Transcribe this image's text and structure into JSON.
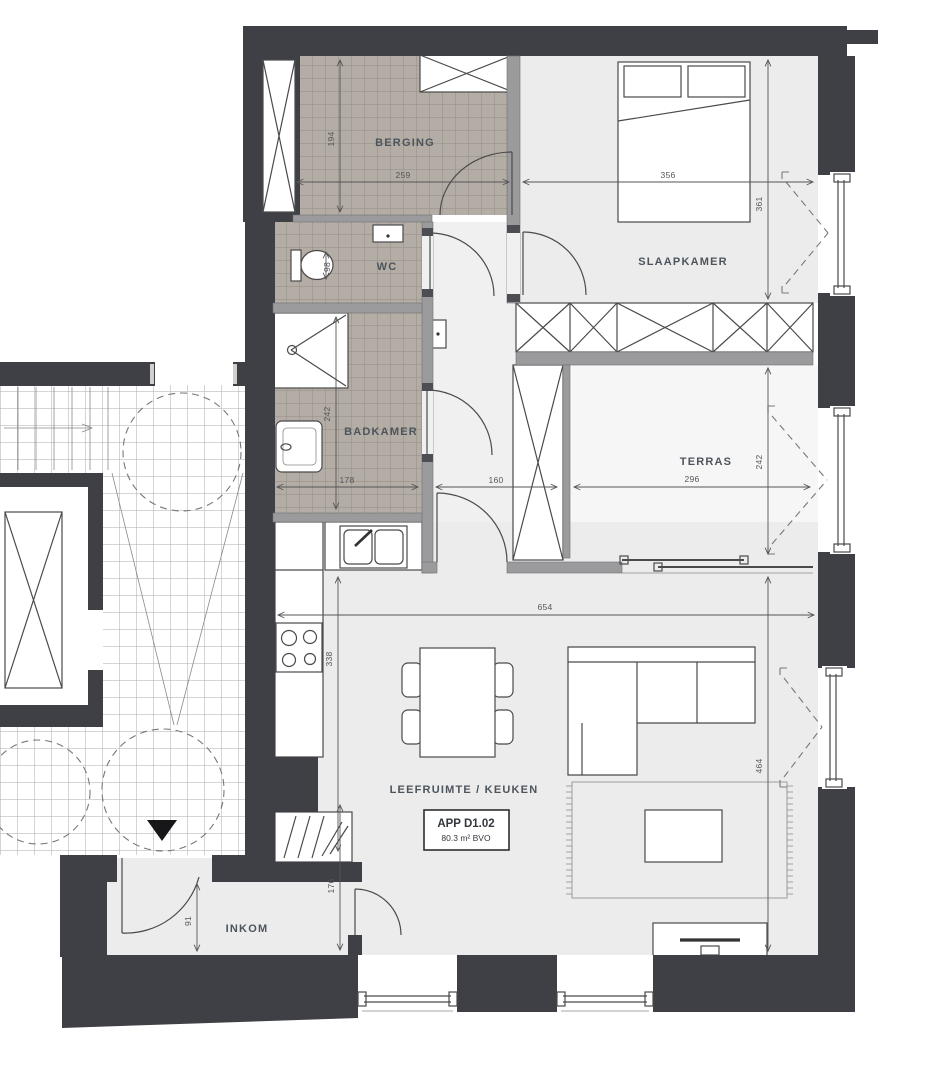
{
  "unit": {
    "id": "APP D1.02",
    "area": "80.3 m² BVO"
  },
  "rooms": {
    "berging": "BERGING",
    "wc": "WC",
    "slaapkamer": "SLAAPKAMER",
    "badkamer": "BADKAMER",
    "terras": "TERRAS",
    "leefruimte": "LEEFRUIMTE / KEUKEN",
    "inkom": "INKOM"
  },
  "dimensions": {
    "berging_height": "194",
    "berging_width": "259",
    "slaapkamer_width": "356",
    "slaapkamer_height": "361",
    "wc_width": "98",
    "badkamer_height": "242",
    "badkamer_width": "178",
    "hal_width": "160",
    "terras_width": "296",
    "terras_height": "242",
    "living_width": "654",
    "keuken_height": "338",
    "living_height": "464",
    "inkom_height": "176",
    "inkom_width": "91"
  },
  "colors": {
    "outer_wall": "#3f4045",
    "partition_wall": "#9b9b9d",
    "wet_room_tile": "#b4ada6",
    "floor": "#ececec",
    "terras_floor": "#f6f6f6",
    "drawing_line": "#4a4a4a"
  }
}
